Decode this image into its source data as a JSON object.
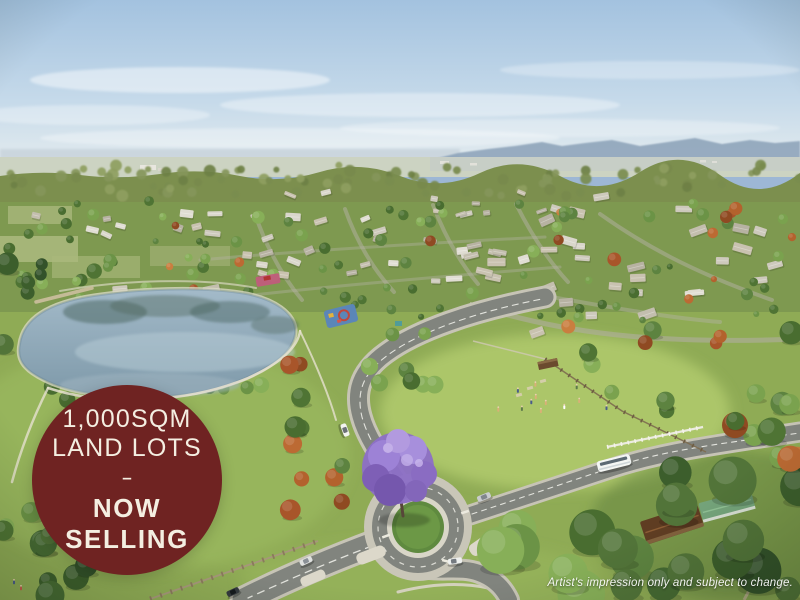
{
  "badge": {
    "line1": "1,000SQM",
    "line2": "LAND LOTS",
    "separator": "–",
    "line3": "NOW",
    "line4": "SELLING",
    "background_color": "#6f2322",
    "text_color": "#f4eee1"
  },
  "disclaimer": {
    "text": "Artist's impression only and subject to change."
  },
  "colors": {
    "sky_top": "#a5c4e0",
    "sky_horizon": "#e4ecef",
    "mountains": "#8ba1b8",
    "water": "#8aa5b6",
    "grass": "#8fab55",
    "road": "#81847e",
    "jacaranda": "#8d6fc6",
    "autumn_tree": "#b4622f",
    "roof_grey": "#d2cec2"
  },
  "scene": {
    "palettes": {
      "green": [
        "#4f7434",
        "#5d8340",
        "#6b9346",
        "#7aa24e",
        "#87af58",
        "#496d30"
      ],
      "dark": [
        "#3c5e2c",
        "#466a33",
        "#33522a",
        "#527439"
      ],
      "orange": [
        "#a8552a",
        "#bc6a33",
        "#8f4a22",
        "#c97e3f",
        "#b3622d"
      ],
      "olive": [
        "#7a8c4e",
        "#84965a",
        "#6e8044",
        "#8e9e60",
        "#77894c"
      ],
      "roof": [
        "#d9d6cb",
        "#cdc9bc",
        "#c3beae",
        "#b7b2a2",
        "#e0ddd3",
        "#c9c2b0"
      ],
      "people": [
        "#e8e4da",
        "#c75b4a",
        "#4a5d8a",
        "#d9b077",
        "#5d7a4a",
        "#ffffff"
      ]
    },
    "treeline": {
      "x": 0,
      "y": 164,
      "w": 800,
      "h": 32,
      "n": 95,
      "rmin": 3,
      "rmax": 6
    },
    "tree_clusters": [
      {
        "x": 150,
        "y": 203,
        "w": 650,
        "h": 120,
        "n": 78,
        "rmin": 3,
        "rmax": 7,
        "p": "m"
      },
      {
        "x": 0,
        "y": 196,
        "w": 150,
        "h": 108,
        "n": 15,
        "rmin": 3,
        "rmax": 7,
        "p": "g"
      },
      {
        "x": 60,
        "y": 256,
        "w": 250,
        "h": 32,
        "n": 12,
        "rmin": 4,
        "rmax": 8,
        "p": "g"
      },
      {
        "x": 0,
        "y": 260,
        "w": 62,
        "h": 135,
        "n": 9,
        "rmin": 6,
        "rmax": 12,
        "p": "d"
      },
      {
        "x": 30,
        "y": 380,
        "w": 300,
        "h": 44,
        "n": 11,
        "rmin": 5,
        "rmax": 9,
        "p": "m"
      },
      {
        "x": 0,
        "y": 396,
        "w": 130,
        "h": 135,
        "n": 8,
        "rmin": 6,
        "rmax": 11,
        "p": "g"
      },
      {
        "x": 555,
        "y": 322,
        "w": 245,
        "h": 92,
        "n": 12,
        "rmin": 6,
        "rmax": 12,
        "p": "m"
      }
    ],
    "front_tree_clusters": [
      {
        "x": 286,
        "y": 358,
        "w": 82,
        "h": 152,
        "n": 11,
        "rmin": 6,
        "rmax": 11,
        "p": "a"
      },
      {
        "x": 362,
        "y": 328,
        "w": 98,
        "h": 78,
        "n": 8,
        "rmin": 5,
        "rmax": 9,
        "p": "m"
      },
      {
        "x": 482,
        "y": 512,
        "w": 150,
        "h": 82,
        "n": 7,
        "rmin": 13,
        "rmax": 25,
        "p": "g"
      },
      {
        "x": 612,
        "y": 462,
        "w": 188,
        "h": 138,
        "n": 13,
        "rmin": 12,
        "rmax": 24,
        "p": "d"
      },
      {
        "x": 733,
        "y": 393,
        "w": 67,
        "h": 88,
        "n": 6,
        "rmin": 8,
        "rmax": 14,
        "p": "m"
      },
      {
        "x": 0,
        "y": 520,
        "w": 185,
        "h": 80,
        "n": 11,
        "rmin": 8,
        "rmax": 16,
        "p": "d"
      },
      {
        "x": 768,
        "y": 428,
        "w": 32,
        "h": 62,
        "n": 3,
        "rmin": 10,
        "rmax": 15,
        "p": "a"
      }
    ],
    "house_clusters": [
      {
        "x": 175,
        "y": 208,
        "w": 320,
        "h": 72,
        "n": 26,
        "s": 1
      },
      {
        "x": 380,
        "y": 250,
        "w": 120,
        "h": 60,
        "n": 8,
        "s": 1
      },
      {
        "x": 495,
        "y": 193,
        "w": 300,
        "h": 140,
        "n": 30,
        "s": 1.15
      },
      {
        "x": 118,
        "y": 276,
        "w": 132,
        "h": 58,
        "n": 7,
        "s": 1.05
      },
      {
        "x": 205,
        "y": 190,
        "w": 340,
        "h": 26,
        "n": 10,
        "s": 0.75
      },
      {
        "x": 15,
        "y": 210,
        "w": 125,
        "h": 32,
        "n": 5,
        "s": 0.8
      }
    ],
    "people": {
      "region": {
        "x": 495,
        "y": 372,
        "w": 112,
        "h": 50
      },
      "n": 12,
      "extra": [
        [
          14,
          584
        ],
        [
          21,
          590
        ]
      ]
    }
  }
}
